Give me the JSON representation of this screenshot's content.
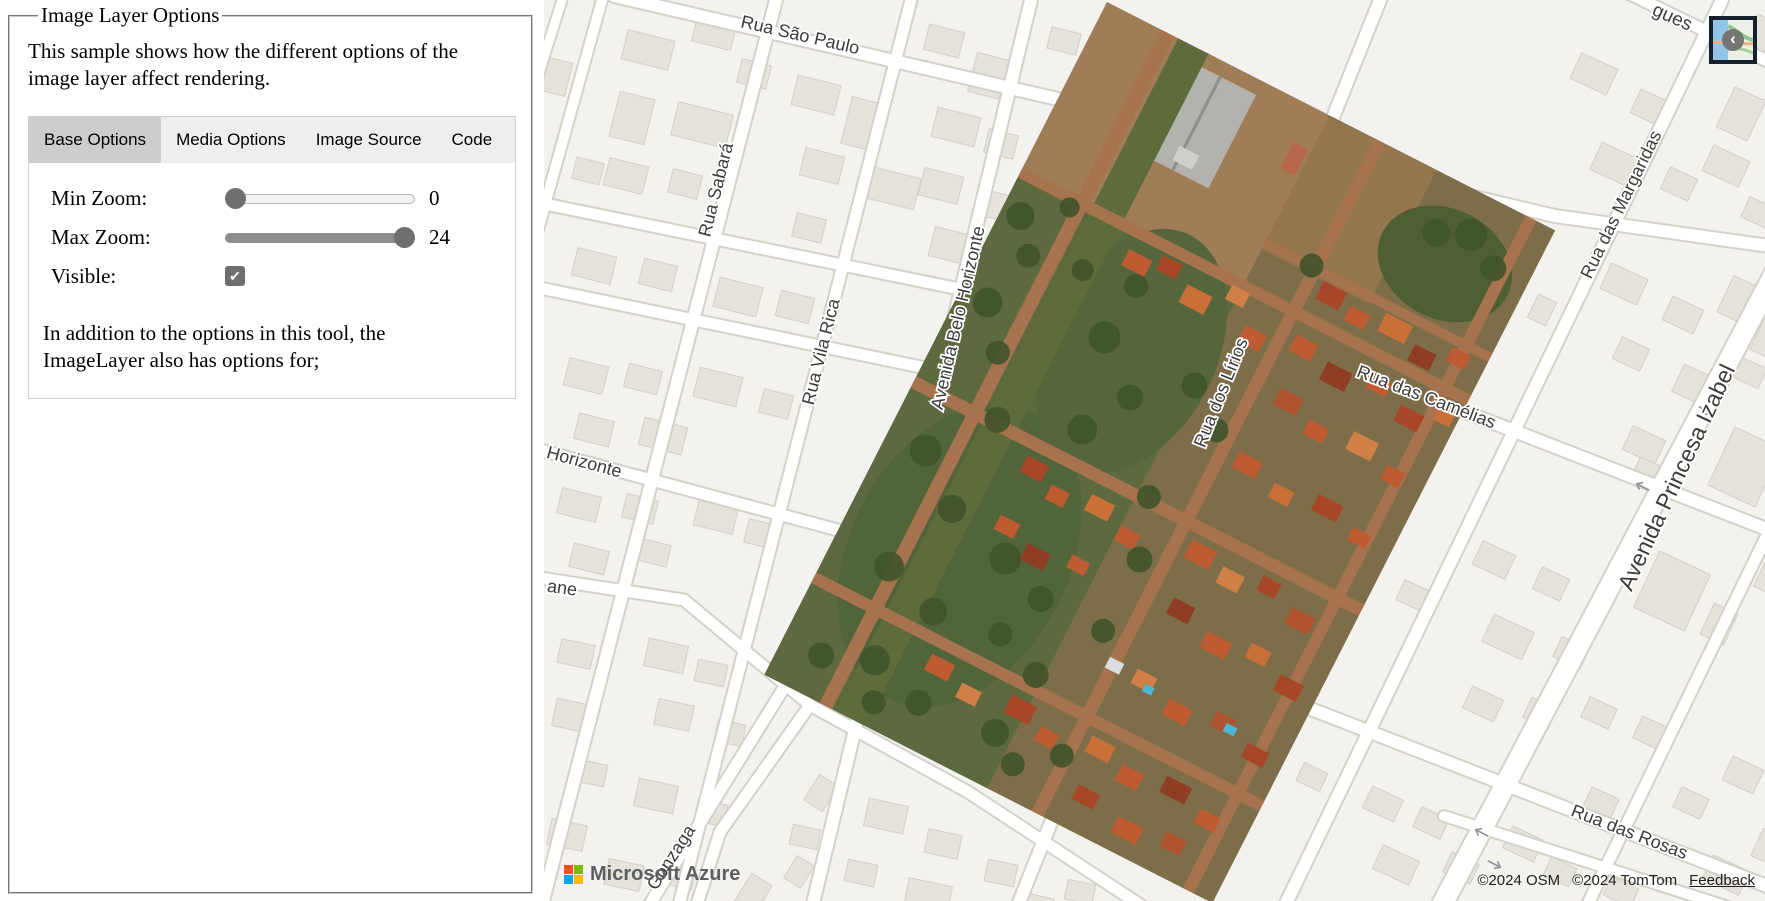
{
  "panel": {
    "legend": "Image Layer Options",
    "intro": "This sample shows how the different options of the image layer affect rendering.",
    "tabs": [
      {
        "label": "Base Options",
        "active": true
      },
      {
        "label": "Media Options",
        "active": false
      },
      {
        "label": "Image Source",
        "active": false
      },
      {
        "label": "Code",
        "active": false
      }
    ],
    "controls": [
      {
        "id": "min-zoom",
        "label": "Min Zoom:",
        "type": "slider",
        "value": "0",
        "fraction": 0
      },
      {
        "id": "max-zoom",
        "label": "Max Zoom:",
        "type": "slider",
        "value": "24",
        "fraction": 1
      },
      {
        "id": "visible",
        "label": "Visible:",
        "type": "checkbox",
        "checked": true,
        "glyph": "✔"
      }
    ],
    "note": "In addition to the options in this tool, the ImageLayer also has options for;"
  },
  "map": {
    "labels": [
      {
        "text": "Rua São Paulo",
        "x": 256,
        "y": 36,
        "r": 13,
        "s": 18
      },
      {
        "text": "Rua Sabará",
        "x": 173,
        "y": 190,
        "r": -76,
        "s": 18
      },
      {
        "text": "Rua Vila Rica",
        "x": 278,
        "y": 352,
        "r": -76,
        "s": 18
      },
      {
        "text": "Avenida Belo Horizonte",
        "x": 415,
        "y": 318,
        "r": -77,
        "s": 18
      },
      {
        "text": "Rua dos Lírios",
        "x": 678,
        "y": 393,
        "r": -68,
        "s": 18
      },
      {
        "text": "Rua das Camélias",
        "x": 882,
        "y": 398,
        "r": 21,
        "s": 18
      },
      {
        "text": "Rua das Margaridas",
        "x": 1078,
        "y": 205,
        "r": -64,
        "s": 18
      },
      {
        "text": "Avenida Princesa Izabel",
        "x": 1134,
        "y": 478,
        "r": -65,
        "s": 23
      },
      {
        "text": "Rua das Rosas",
        "x": 1085,
        "y": 833,
        "r": 21,
        "s": 18
      },
      {
        "text": "Horizonte",
        "x": 40,
        "y": 463,
        "r": 15,
        "s": 18
      },
      {
        "text": "ane",
        "x": 18,
        "y": 589,
        "r": 8,
        "s": 18
      },
      {
        "text": "Gonzaga",
        "x": 128,
        "y": 858,
        "r": -57,
        "s": 18
      },
      {
        "text": "gues",
        "x": 1128,
        "y": 18,
        "r": 24,
        "s": 19
      }
    ],
    "attribution": {
      "osm": "©2024 OSM",
      "tomtom": "©2024 TomTom",
      "feedback": "Feedback"
    },
    "watermark": "Microsoft Azure",
    "style_button": {
      "glyph": "‹"
    }
  },
  "colors": {
    "accent_gray": "#6f6f6f",
    "ms_logo": [
      "#f25022",
      "#7fba00",
      "#00a4ef",
      "#ffb900"
    ]
  }
}
